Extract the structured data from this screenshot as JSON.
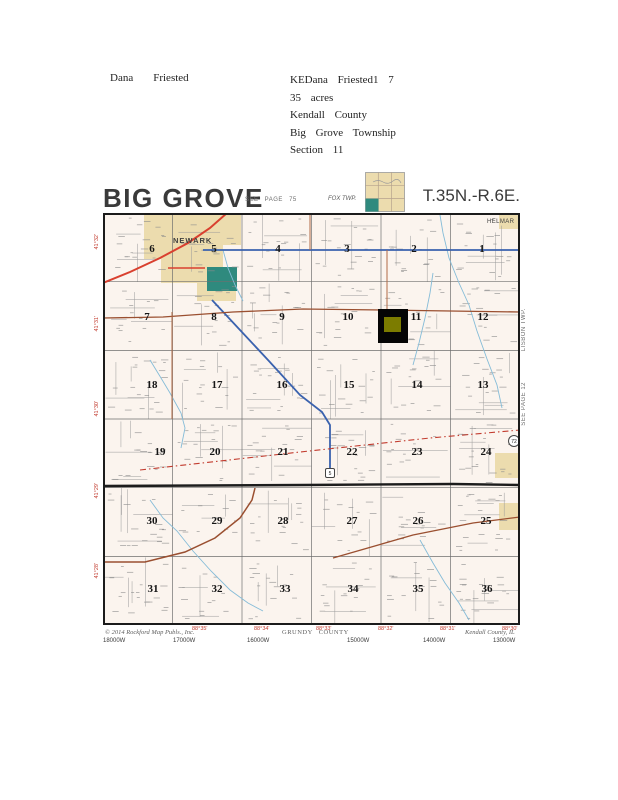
{
  "header": {
    "owner_first": "Dana",
    "owner_last": "Friested",
    "details": [
      "KEDana Friested1 7",
      "35 acres",
      "Kendall County",
      "Big Grove Township",
      "Section 11"
    ]
  },
  "map": {
    "title": "BIG GROVE",
    "township_range": "T.35N.-R.6E.",
    "see_page": "SEE PAGE 75",
    "adjacent_top": "FOX TWP.",
    "adjacent_right": [
      {
        "text": "LISBON TWP.",
        "y": 138
      },
      {
        "text": "SEE PAGE 12",
        "y": 212
      }
    ],
    "place_labels": [
      {
        "text": "NEWARK",
        "x": 70,
        "y": 30,
        "size": 7.5,
        "bold": true,
        "ls": 1
      },
      {
        "text": "HELMAR",
        "x": 384,
        "y": 10,
        "size": 6,
        "bold": false,
        "ls": 0.4
      }
    ],
    "sections": [
      {
        "n": "6",
        "x": 49,
        "y": 35
      },
      {
        "n": "5",
        "x": 111,
        "y": 35
      },
      {
        "n": "4",
        "x": 175,
        "y": 35
      },
      {
        "n": "3",
        "x": 244,
        "y": 35
      },
      {
        "n": "2",
        "x": 311,
        "y": 35
      },
      {
        "n": "1",
        "x": 379,
        "y": 35
      },
      {
        "n": "7",
        "x": 44,
        "y": 103
      },
      {
        "n": "8",
        "x": 111,
        "y": 103
      },
      {
        "n": "9",
        "x": 179,
        "y": 103
      },
      {
        "n": "10",
        "x": 245,
        "y": 103
      },
      {
        "n": "11",
        "x": 313,
        "y": 103
      },
      {
        "n": "12",
        "x": 380,
        "y": 103
      },
      {
        "n": "18",
        "x": 49,
        "y": 171
      },
      {
        "n": "17",
        "x": 114,
        "y": 171
      },
      {
        "n": "16",
        "x": 179,
        "y": 171
      },
      {
        "n": "15",
        "x": 246,
        "y": 171
      },
      {
        "n": "14",
        "x": 314,
        "y": 171
      },
      {
        "n": "13",
        "x": 380,
        "y": 171
      },
      {
        "n": "19",
        "x": 57,
        "y": 238
      },
      {
        "n": "20",
        "x": 112,
        "y": 238
      },
      {
        "n": "21",
        "x": 180,
        "y": 238
      },
      {
        "n": "22",
        "x": 249,
        "y": 238
      },
      {
        "n": "23",
        "x": 314,
        "y": 238
      },
      {
        "n": "24",
        "x": 383,
        "y": 238
      },
      {
        "n": "30",
        "x": 49,
        "y": 307
      },
      {
        "n": "29",
        "x": 114,
        "y": 307
      },
      {
        "n": "28",
        "x": 180,
        "y": 307
      },
      {
        "n": "27",
        "x": 249,
        "y": 307
      },
      {
        "n": "26",
        "x": 315,
        "y": 307
      },
      {
        "n": "25",
        "x": 383,
        "y": 307
      },
      {
        "n": "31",
        "x": 50,
        "y": 375
      },
      {
        "n": "32",
        "x": 114,
        "y": 375
      },
      {
        "n": "33",
        "x": 182,
        "y": 375
      },
      {
        "n": "34",
        "x": 250,
        "y": 375
      },
      {
        "n": "35",
        "x": 315,
        "y": 375
      },
      {
        "n": "36",
        "x": 384,
        "y": 375
      }
    ],
    "latitude_labels": [
      {
        "text": "41°32'",
        "y": 78
      },
      {
        "text": "41°31'",
        "y": 160
      },
      {
        "text": "41°30'",
        "y": 245
      },
      {
        "text": "41°29'",
        "y": 327
      },
      {
        "text": "41°28'",
        "y": 407
      }
    ],
    "longitude_labels": [
      {
        "text": "88°35'",
        "x": 95
      },
      {
        "text": "88°34'",
        "x": 157
      },
      {
        "text": "88°33'",
        "x": 219
      },
      {
        "text": "88°32'",
        "x": 281
      },
      {
        "text": "88°31'",
        "x": 343
      },
      {
        "text": "88°30'",
        "x": 405
      }
    ],
    "grid_w_labels": [
      {
        "text": "18000W",
        "x": 6
      },
      {
        "text": "17000W",
        "x": 76
      },
      {
        "text": "16000W",
        "x": 150
      },
      {
        "text": "15000W",
        "x": 250
      },
      {
        "text": "14000W",
        "x": 326
      },
      {
        "text": "13000W",
        "x": 396
      }
    ],
    "credits": {
      "left": "© 2014 Rockford Map Publs., Inc.",
      "center": "GRUNDY COUNTY",
      "right": "Kendall County, IL"
    },
    "route_shields": [
      {
        "text": "72",
        "x": 411,
        "y": 228,
        "shape": "circle"
      },
      {
        "text": "5",
        "x": 227,
        "y": 260,
        "shape": "rect"
      }
    ],
    "highlight": {
      "x": 275,
      "y": 96,
      "w": 30,
      "h": 34,
      "outer_color": "#050505",
      "inner": {
        "x": 281,
        "y": 104,
        "w": 17,
        "h": 15,
        "color": "#7c7c00"
      }
    },
    "colors": {
      "map_bg": "#fbf4ee",
      "beige": "#ecdcae",
      "teal": "#2f8a7e",
      "red_road": "#d9402f",
      "blue_road": "#3a62ae",
      "brown_road": "#9a4f30",
      "brown_light": "#b06a45",
      "black_road": "#1c1c1c",
      "creek": "#85bcd8",
      "grid": "#6f6f6f",
      "noise": "#9a9a9a",
      "coord_red": "#c23b2e"
    },
    "areas": {
      "beige_polys": [
        [
          [
            41,
            0
          ],
          [
            138,
            0
          ],
          [
            138,
            32
          ],
          [
            120,
            32
          ],
          [
            120,
            60
          ],
          [
            133,
            60
          ],
          [
            133,
            88
          ],
          [
            94,
            88
          ],
          [
            94,
            70
          ],
          [
            58,
            70
          ],
          [
            58,
            46
          ],
          [
            41,
            46
          ]
        ],
        [
          [
            392,
            240
          ],
          [
            415,
            240
          ],
          [
            415,
            265
          ],
          [
            392,
            265
          ]
        ],
        [
          [
            396,
            290
          ],
          [
            417,
            290
          ],
          [
            417,
            317
          ],
          [
            396,
            317
          ]
        ],
        [
          [
            396,
            0
          ],
          [
            417,
            0
          ],
          [
            417,
            16
          ],
          [
            396,
            16
          ]
        ]
      ],
      "teal_rects": [
        [
          104,
          54,
          30,
          24
        ]
      ]
    },
    "roads": [
      {
        "name": "red-highway",
        "color": "red_road",
        "width": 2,
        "points": [
          [
            124,
            0
          ],
          [
            107,
            15
          ],
          [
            85,
            30
          ],
          [
            57,
            45
          ],
          [
            27,
            59
          ],
          [
            0,
            70
          ]
        ]
      },
      {
        "name": "red-spur",
        "color": "red_road",
        "width": 1.6,
        "points": [
          [
            65,
            55
          ],
          [
            102,
            55
          ]
        ]
      },
      {
        "name": "blue-route-top",
        "color": "blue_road",
        "width": 1.8,
        "points": [
          [
            100,
            37
          ],
          [
            417,
            37
          ]
        ]
      },
      {
        "name": "blue-route-diagonal",
        "color": "blue_road",
        "width": 1.8,
        "points": [
          [
            109,
            87
          ],
          [
            137,
            117
          ],
          [
            165,
            147
          ],
          [
            197,
            182
          ],
          [
            219,
            199
          ],
          [
            227,
            212
          ],
          [
            227,
            256
          ]
        ]
      },
      {
        "name": "brown-road-north",
        "color": "brown_road",
        "width": 1.3,
        "points": [
          [
            0,
            105
          ],
          [
            60,
            104
          ],
          [
            130,
            99
          ],
          [
            200,
            96
          ],
          [
            280,
            97
          ],
          [
            417,
            99
          ]
        ]
      },
      {
        "name": "black-county-road",
        "color": "black_road",
        "width": 2.4,
        "points": [
          [
            0,
            273
          ],
          [
            200,
            272
          ],
          [
            350,
            271
          ],
          [
            417,
            272
          ]
        ]
      },
      {
        "name": "dashed-road",
        "color": "coord_red",
        "width": 1.1,
        "dash": "6 3 1.5 3",
        "points": [
          [
            37,
            257
          ],
          [
            197,
            239
          ],
          [
            327,
            225
          ],
          [
            417,
            217
          ]
        ]
      },
      {
        "name": "brown-road-southwest",
        "color": "brown_road",
        "width": 1.5,
        "points": [
          [
            0,
            349
          ],
          [
            42,
            349
          ],
          [
            82,
            339
          ],
          [
            112,
            325
          ],
          [
            137,
            305
          ],
          [
            149,
            287
          ],
          [
            152,
            275
          ]
        ]
      },
      {
        "name": "brown-road-southeast",
        "color": "brown_road",
        "width": 1.3,
        "points": [
          [
            230,
            345
          ],
          [
            310,
            322
          ],
          [
            370,
            310
          ],
          [
            417,
            304
          ]
        ]
      },
      {
        "name": "brown-vertical-1",
        "color": "brown_light",
        "width": 1,
        "points": [
          [
            207,
            0
          ],
          [
            207,
            37
          ]
        ]
      },
      {
        "name": "brown-vertical-2",
        "color": "brown_light",
        "width": 1,
        "points": [
          [
            284,
            37
          ],
          [
            284,
            99
          ]
        ]
      },
      {
        "name": "brown-vertical-3",
        "color": "brown_light",
        "width": 1,
        "points": [
          [
            69,
            99
          ],
          [
            69,
            206
          ]
        ]
      }
    ],
    "creeks": [
      [
        [
          337,
          2
        ],
        [
          340,
          20
        ],
        [
          346,
          45
        ],
        [
          356,
          70
        ],
        [
          366,
          92
        ],
        [
          374,
          118
        ],
        [
          384,
          146
        ],
        [
          394,
          172
        ],
        [
          399,
          195
        ]
      ],
      [
        [
          330,
          60
        ],
        [
          327,
          80
        ],
        [
          322,
          105
        ],
        [
          316,
          130
        ],
        [
          310,
          152
        ]
      ],
      [
        [
          47,
          147
        ],
        [
          58,
          165
        ],
        [
          67,
          180
        ],
        [
          78,
          200
        ],
        [
          82,
          215
        ],
        [
          78,
          235
        ]
      ],
      [
        [
          47,
          287
        ],
        [
          60,
          305
        ],
        [
          74,
          318
        ],
        [
          90,
          338
        ],
        [
          108,
          358
        ],
        [
          127,
          377
        ],
        [
          145,
          390
        ],
        [
          160,
          398
        ]
      ],
      [
        [
          317,
          327
        ],
        [
          330,
          350
        ],
        [
          342,
          370
        ],
        [
          356,
          390
        ],
        [
          366,
          407
        ]
      ],
      [
        [
          120,
          37
        ],
        [
          125,
          55
        ],
        [
          132,
          72
        ],
        [
          140,
          88
        ]
      ]
    ]
  }
}
